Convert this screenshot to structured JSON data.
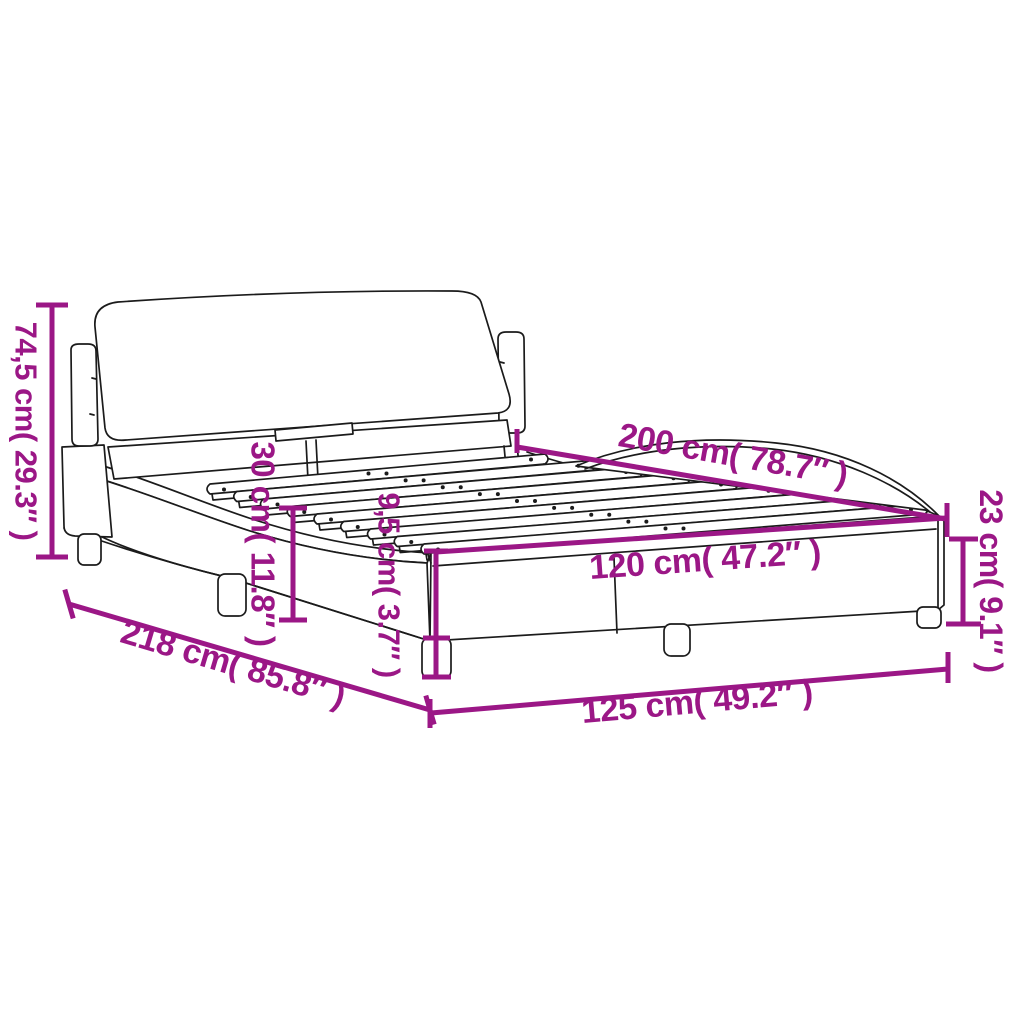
{
  "diagram": {
    "type": "product-dimension-diagram",
    "subject": "upholstered bed frame with headboard, curved side rails and slatted base",
    "background_color": "#ffffff",
    "line_color": "#1b1b1b",
    "accent_color": "#9B1786",
    "dimensions": {
      "total_height": {
        "label": "74,5 cm( 29.3″ )",
        "cm": "74,5",
        "inches": "29.3"
      },
      "headboard_clearance": {
        "label": "30 cm( 11.8″ )",
        "cm": "30",
        "inches": "11.8"
      },
      "leg_height": {
        "label": "9,5 cm( 3.7″ )",
        "cm": "9,5",
        "inches": "3.7"
      },
      "mattress_length": {
        "label": "200 cm( 78.7″ )",
        "cm": "200",
        "inches": "78.7"
      },
      "mattress_width": {
        "label": "120 cm( 47.2″ )",
        "cm": "120",
        "inches": "47.2"
      },
      "foot_end_height": {
        "label": "23 cm( 9.1″ )",
        "cm": "23",
        "inches": "9.1"
      },
      "total_length": {
        "label": "218 cm( 85.8″ )",
        "cm": "218",
        "inches": "85.8"
      },
      "total_width": {
        "label": "125 cm( 49.2″ )",
        "cm": "125",
        "inches": "49.2"
      }
    }
  }
}
